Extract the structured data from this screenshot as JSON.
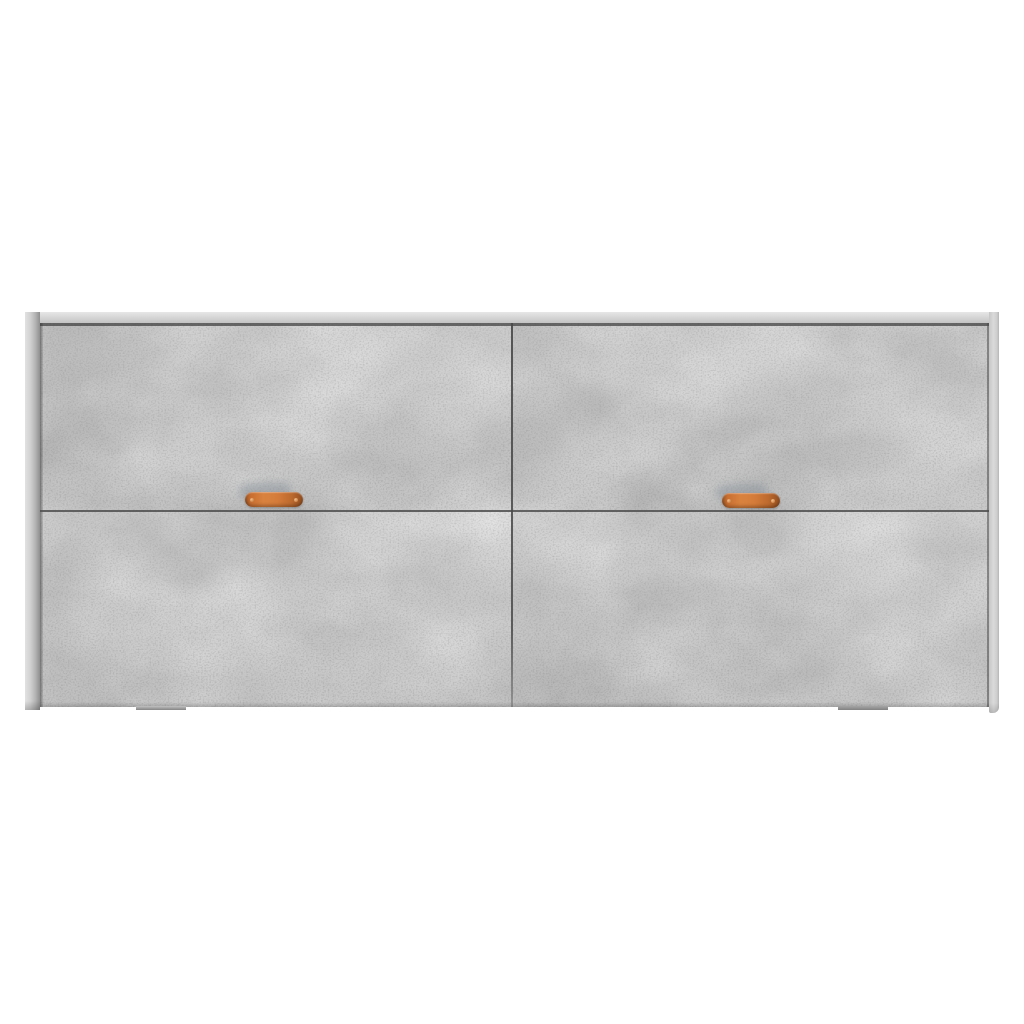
{
  "image": {
    "kind": "product-photo",
    "subject": "sideboard-cabinet",
    "description": "Front view of a concrete-gray sideboard cabinet with four door panels in two rows, two copper-orange leather-look pull tabs on the upper doors, and two slim feet, on a plain white background",
    "background_color": "#ffffff"
  },
  "sideboard": {
    "finish": "concrete gray",
    "doors": {
      "count": 4,
      "layout": "2 columns x 2 rows",
      "upper_row": "flip-front doors with pull tabs",
      "lower_row": "plain push doors"
    },
    "handles": {
      "count": 2,
      "style": "leather-look pull tab with rivets",
      "color": "#d07b3a",
      "color_dark": "#9c5624",
      "rivet_color": "#ecab72"
    },
    "feet": {
      "count": 2,
      "color": "#8f8f8f"
    },
    "palette": {
      "carcass_light": "#e2e2e2",
      "carcass_mid": "#c6c6c6",
      "carcass_dark": "#8f8f8f",
      "concrete_base": "#b7b7b7",
      "concrete_light": "#d4d4d4",
      "concrete_dark": "#969696",
      "seam": "#4e4e4e",
      "background": "#ffffff"
    }
  }
}
